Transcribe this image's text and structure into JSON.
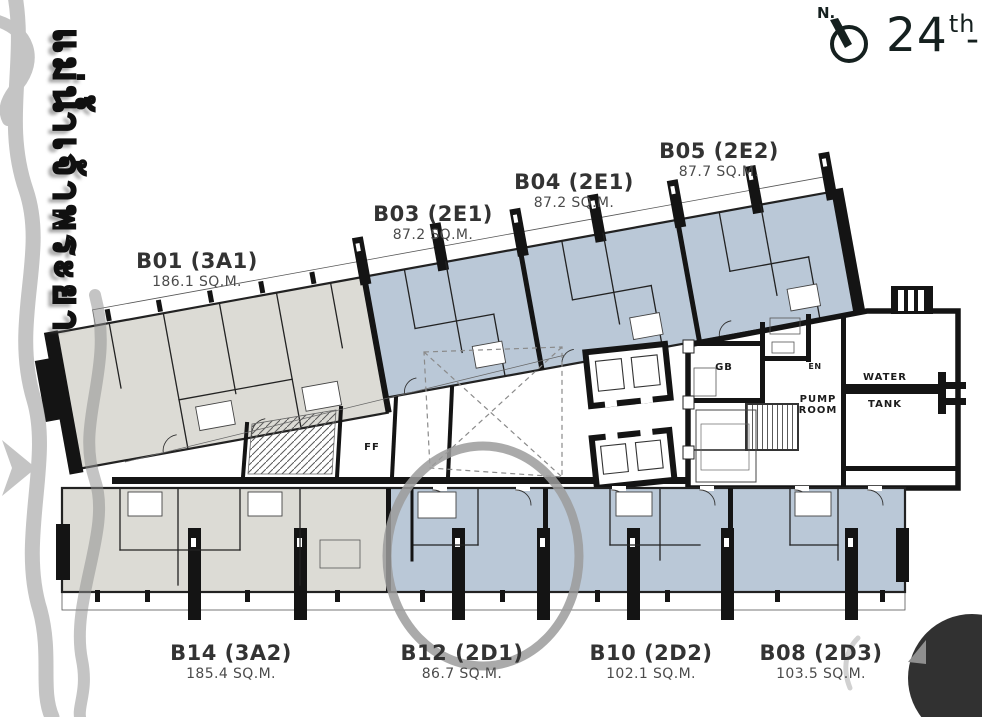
{
  "page": {
    "background": "#ffffff"
  },
  "header": {
    "north_label": "N.",
    "floor_number": "24",
    "floor_ordinal_suffix": "th",
    "floor_range_dash": "-"
  },
  "watermark": {
    "river_text": "แม่น้ำเจ้าพระยา"
  },
  "units": [
    {
      "code": "B01 (3A1)",
      "area": "186.1 SQ.M.",
      "wing": "upper",
      "highlighted": false
    },
    {
      "code": "B03 (2E1)",
      "area": "87.2 SQ.M.",
      "wing": "upper",
      "highlighted": false
    },
    {
      "code": "B04 (2E1)",
      "area": "87.2 SQ.M.",
      "wing": "upper",
      "highlighted": false
    },
    {
      "code": "B05 (2E2)",
      "area": "87.7 SQ.M.",
      "wing": "upper",
      "highlighted": false
    },
    {
      "code": "B14 (3A2)",
      "area": "185.4 SQ.M.",
      "wing": "lower",
      "highlighted": false
    },
    {
      "code": "B12 (2D1)",
      "area": "86.7 SQ.M.",
      "wing": "lower",
      "highlighted": true
    },
    {
      "code": "B10 (2D2)",
      "area": "102.1 SQ.M.",
      "wing": "lower",
      "highlighted": false
    },
    {
      "code": "B08 (2D3)",
      "area": "103.5 SQ.M.",
      "wing": "lower",
      "highlighted": false
    }
  ],
  "service_rooms": {
    "gb": "GB",
    "en": "EN",
    "ff": "FF",
    "pump_room": [
      "PUMP",
      "ROOM"
    ],
    "water_tank": [
      "WATER",
      "TANK"
    ]
  },
  "annotation": {
    "type": "circle",
    "around_unit": "B12 (2D1)"
  },
  "colors": {
    "unit_blue": "#bac8d7",
    "unit_gray": "#dcdbd5",
    "wall": "#141414",
    "annotation_gray": "#9b9b9b",
    "river_gray": "#8e8e8e",
    "corner_blob": "#262626"
  }
}
